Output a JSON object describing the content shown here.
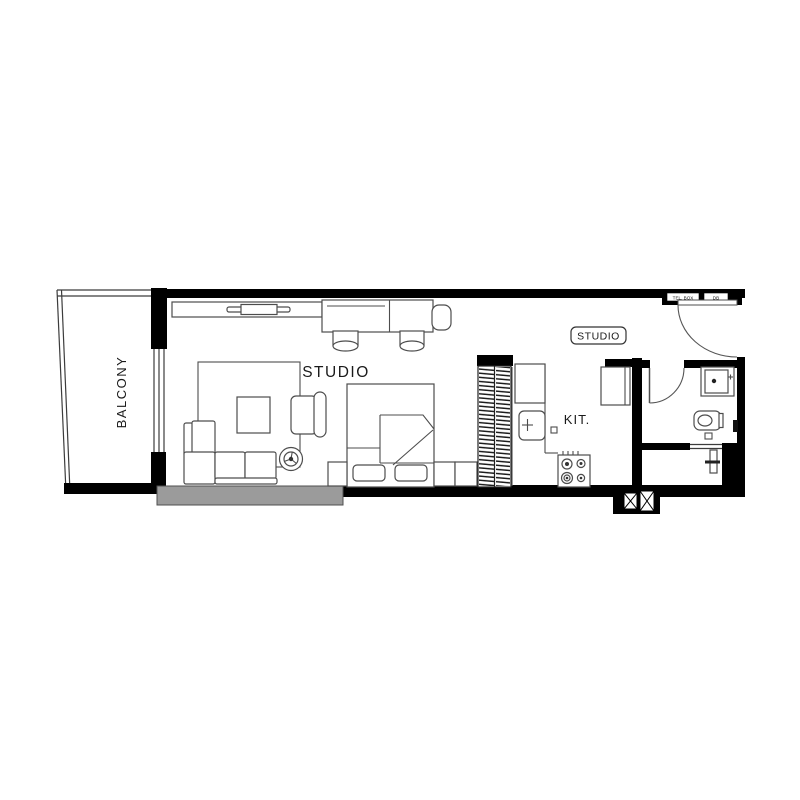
{
  "plan": {
    "rooms": {
      "balcony": {
        "label": "BALCONY"
      },
      "studio": {
        "label": "STUDIO"
      },
      "kitchen": {
        "label": "KIT."
      },
      "unit_badge": {
        "label": "STUDIO"
      }
    },
    "utilities": {
      "tel_box": "TEL. BOX",
      "db": "DB"
    },
    "colors": {
      "wall": "#000000",
      "furniture_line": "#4d4d4d",
      "window_sill_gray": "#9b9b9b",
      "background": "#ffffff"
    }
  }
}
